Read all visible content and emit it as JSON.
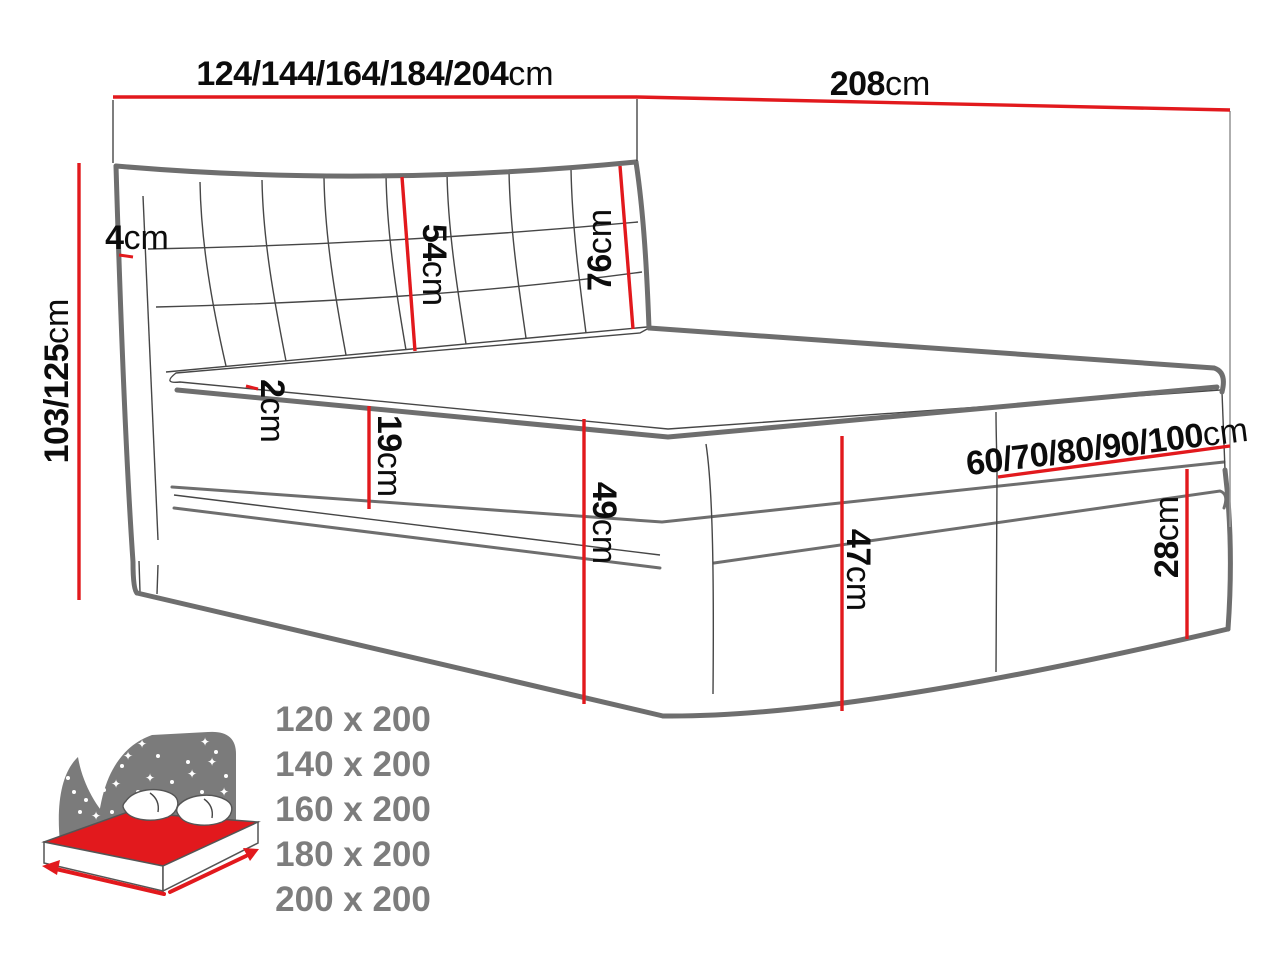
{
  "dims": {
    "width": {
      "value": "124/144/164/184/204",
      "unit": "cm"
    },
    "depth": {
      "value": "208",
      "unit": "cm"
    },
    "height": {
      "value": "103/125",
      "unit": "cm"
    },
    "headboard_side": {
      "value": "4",
      "unit": "cm"
    },
    "headboard_panel": {
      "value": "54",
      "unit": "cm"
    },
    "headboard_upper": {
      "value": "76",
      "unit": "cm"
    },
    "topper": {
      "value": "2",
      "unit": "cm"
    },
    "mattress": {
      "value": "19",
      "unit": "cm"
    },
    "base_front": {
      "value": "49",
      "unit": "cm"
    },
    "base_side": {
      "value": "47",
      "unit": "cm"
    },
    "box_lower": {
      "value": "28",
      "unit": "cm"
    },
    "box_width": {
      "value": "60/70/80/90/100",
      "unit": "cm"
    }
  },
  "size_list": {
    "items": [
      "120 x 200",
      "140 x 200",
      "160 x 200",
      "180 x 200",
      "200 x 200"
    ]
  },
  "icon": {
    "name": "bed-sizes-icon"
  },
  "colors": {
    "dimension_line": "#e2191d",
    "drawing_outline": "#6e6e6e",
    "drawing_thin": "#464646",
    "muted_text": "#7d7d7d",
    "label_text": "#0c0c0c"
  }
}
